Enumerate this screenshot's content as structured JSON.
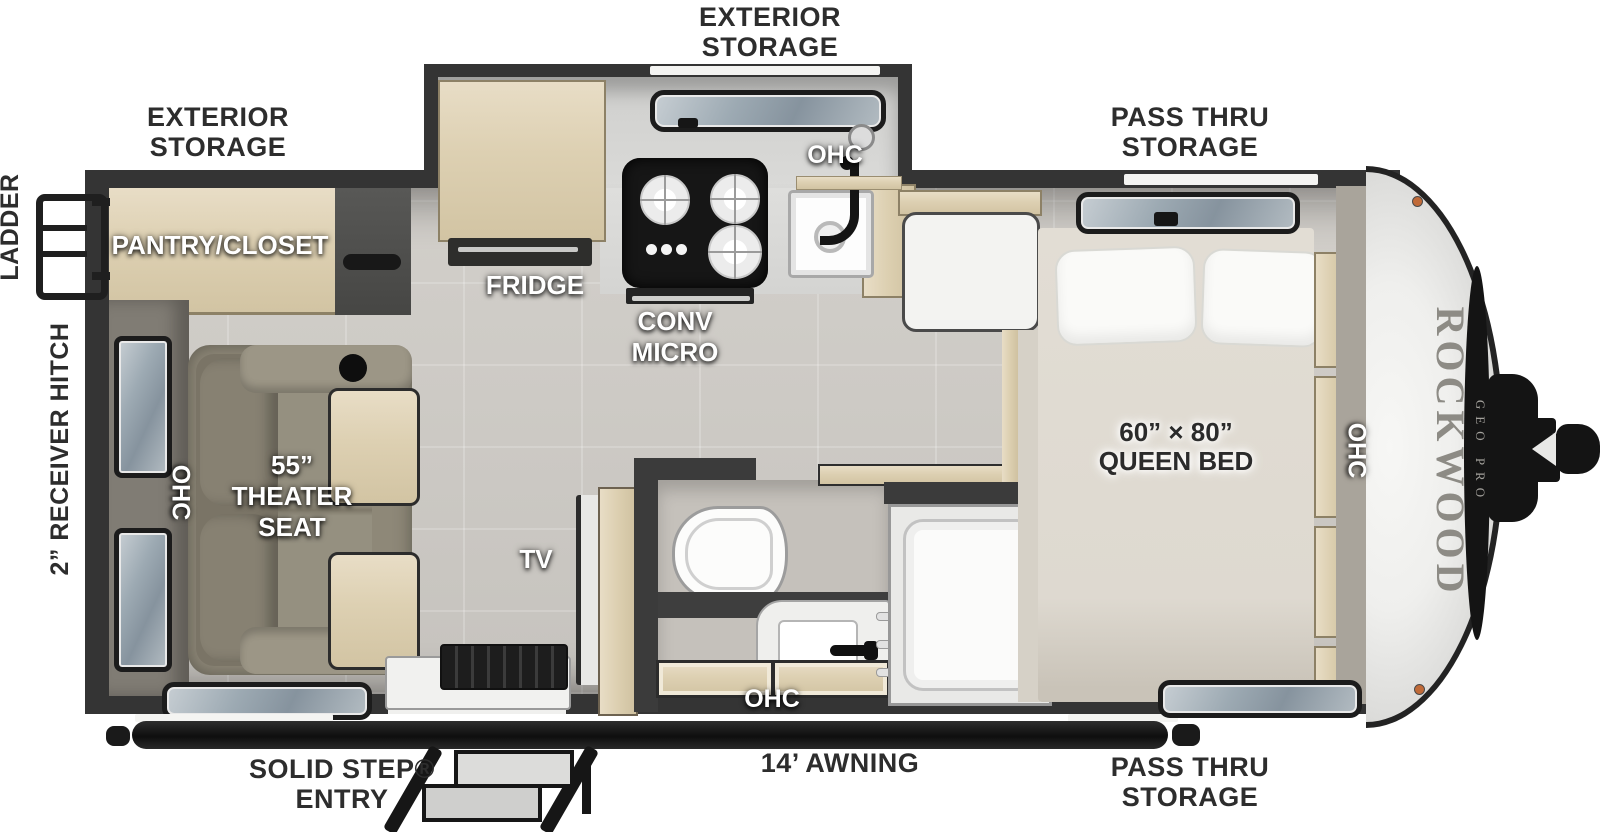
{
  "title": "Rockwood Geo Pro travel trailer floor plan",
  "exterior": {
    "storage_slide": {
      "line1": "EXTERIOR",
      "line2": "STORAGE"
    },
    "storage_rear": {
      "line1": "EXTERIOR",
      "line2": "STORAGE"
    },
    "pass_thru_top": {
      "line1": "PASS THRU",
      "line2": "STORAGE"
    },
    "pass_thru_bottom": {
      "line1": "PASS THRU",
      "line2": "STORAGE"
    },
    "ladder": "LADDER",
    "receiver_hitch": "2” RECEIVER HITCH",
    "solid_step": {
      "line1": "SOLID STEP®",
      "line2": "ENTRY"
    },
    "awning": "14’ AWNING"
  },
  "interior": {
    "pantry": "PANTRY/CLOSET",
    "fridge": "FRIDGE",
    "conv_micro": {
      "line1": "CONV",
      "line2": "MICRO"
    },
    "ohc_kitchen": "OHC",
    "ohc_rear": "OHC",
    "ohc_bath": "OHC",
    "ohc_bed": "OHC",
    "theater_seat": {
      "line1": "55”",
      "line2": "THEATER",
      "line3": "SEAT"
    },
    "tv": "TV",
    "queen_bed": {
      "line1": "60” × 80”",
      "line2": "QUEEN BED"
    }
  },
  "brand": {
    "name": "ROCKWOOD",
    "sub": "GEO PRO"
  },
  "palette": {
    "wall": "#343434",
    "floor_tile": "#cac7c2",
    "wood": "#ddd0b2",
    "seat_fabric": "#8e8878",
    "bed": "#ded9d0",
    "cap_white": "#efefed",
    "accent_black": "#141414",
    "marker_light": "#c06a38",
    "label_dark": "#2d2d2d",
    "label_light": "#ffffff"
  }
}
